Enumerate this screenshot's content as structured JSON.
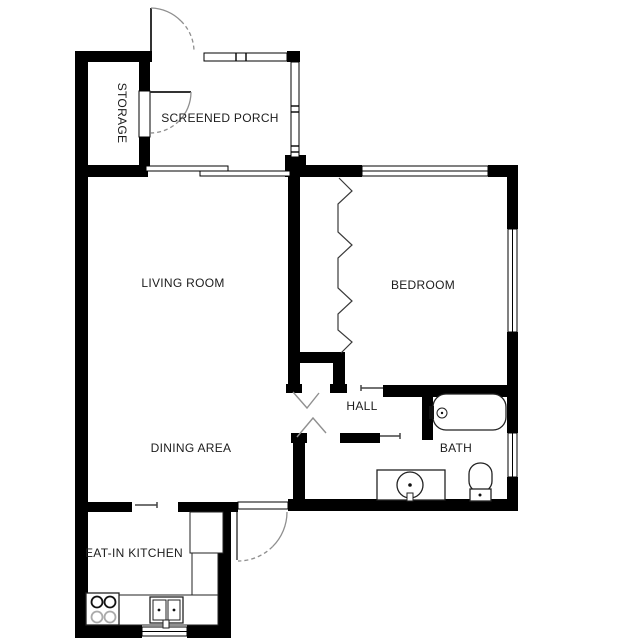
{
  "plan": {
    "rooms": {
      "storage": "STORAGE",
      "screened_porch": "SCREENED PORCH",
      "living_room": "LIVING ROOM",
      "bedroom": "BEDROOM",
      "hall": "HALL",
      "bath": "BATH",
      "dining_area": "DINING AREA",
      "eat_in_kitchen": "EAT-IN KITCHEN"
    },
    "colors": {
      "background": "#ffffff",
      "walls": "#000000",
      "fixture_lines": "#222222",
      "door_swings": "#8f8f8f",
      "labels": "#1c1c1c"
    },
    "fixtures": [
      "bathtub",
      "toilet",
      "vanity-sink",
      "double-kitchen-sink",
      "stove-4-burner",
      "refrigerator",
      "kitchen-counter"
    ],
    "door_features": [
      "entry-door-swing",
      "storage-door-swing",
      "patio-door-swing",
      "sliding-glass-door",
      "bifold-closet-doors",
      "hall-closet-doors",
      "screened-walls"
    ]
  }
}
